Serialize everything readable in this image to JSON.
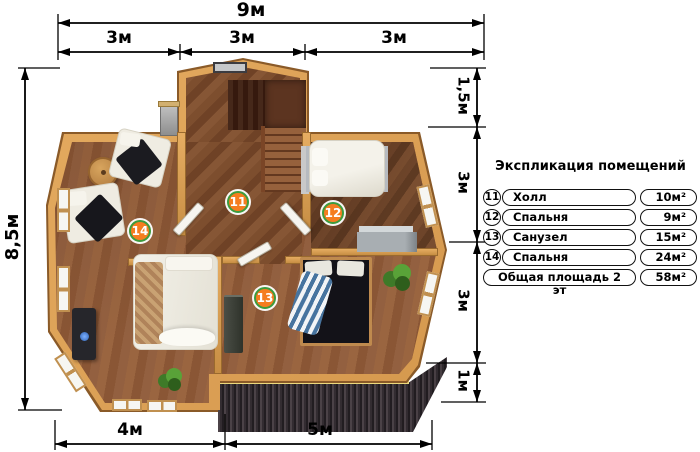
{
  "dimensions": {
    "top_total": "9м",
    "top_segments": [
      "3м",
      "3м",
      "3м"
    ],
    "left_height": "8,5м",
    "right_segments": [
      "1,5м",
      "3м",
      "3м",
      "1м"
    ],
    "bottom_segments": [
      "4м",
      "5м"
    ]
  },
  "legend": {
    "title": "Экспликация помещений",
    "rows": [
      {
        "num": "11",
        "name": "Холл",
        "area": "10м²"
      },
      {
        "num": "12",
        "name": "Спальня",
        "area": "9м²"
      },
      {
        "num": "13",
        "name": "Санузел",
        "area": "15м²"
      },
      {
        "num": "14",
        "name": "Спальня",
        "area": "24м²"
      }
    ],
    "total_row": {
      "name": "Общая площадь 2 эт",
      "area": "58м²"
    }
  },
  "room_badges": [
    {
      "num": "11"
    },
    {
      "num": "12"
    },
    {
      "num": "13"
    },
    {
      "num": "14"
    }
  ],
  "colors": {
    "badge_orange": "#f57d1f",
    "badge_ring_green": "#3d9b3d",
    "wall_wood": "#dda15a",
    "floor_brown": "#8a5635",
    "roof_dark": "#332c31",
    "dimension_black": "#000000"
  }
}
